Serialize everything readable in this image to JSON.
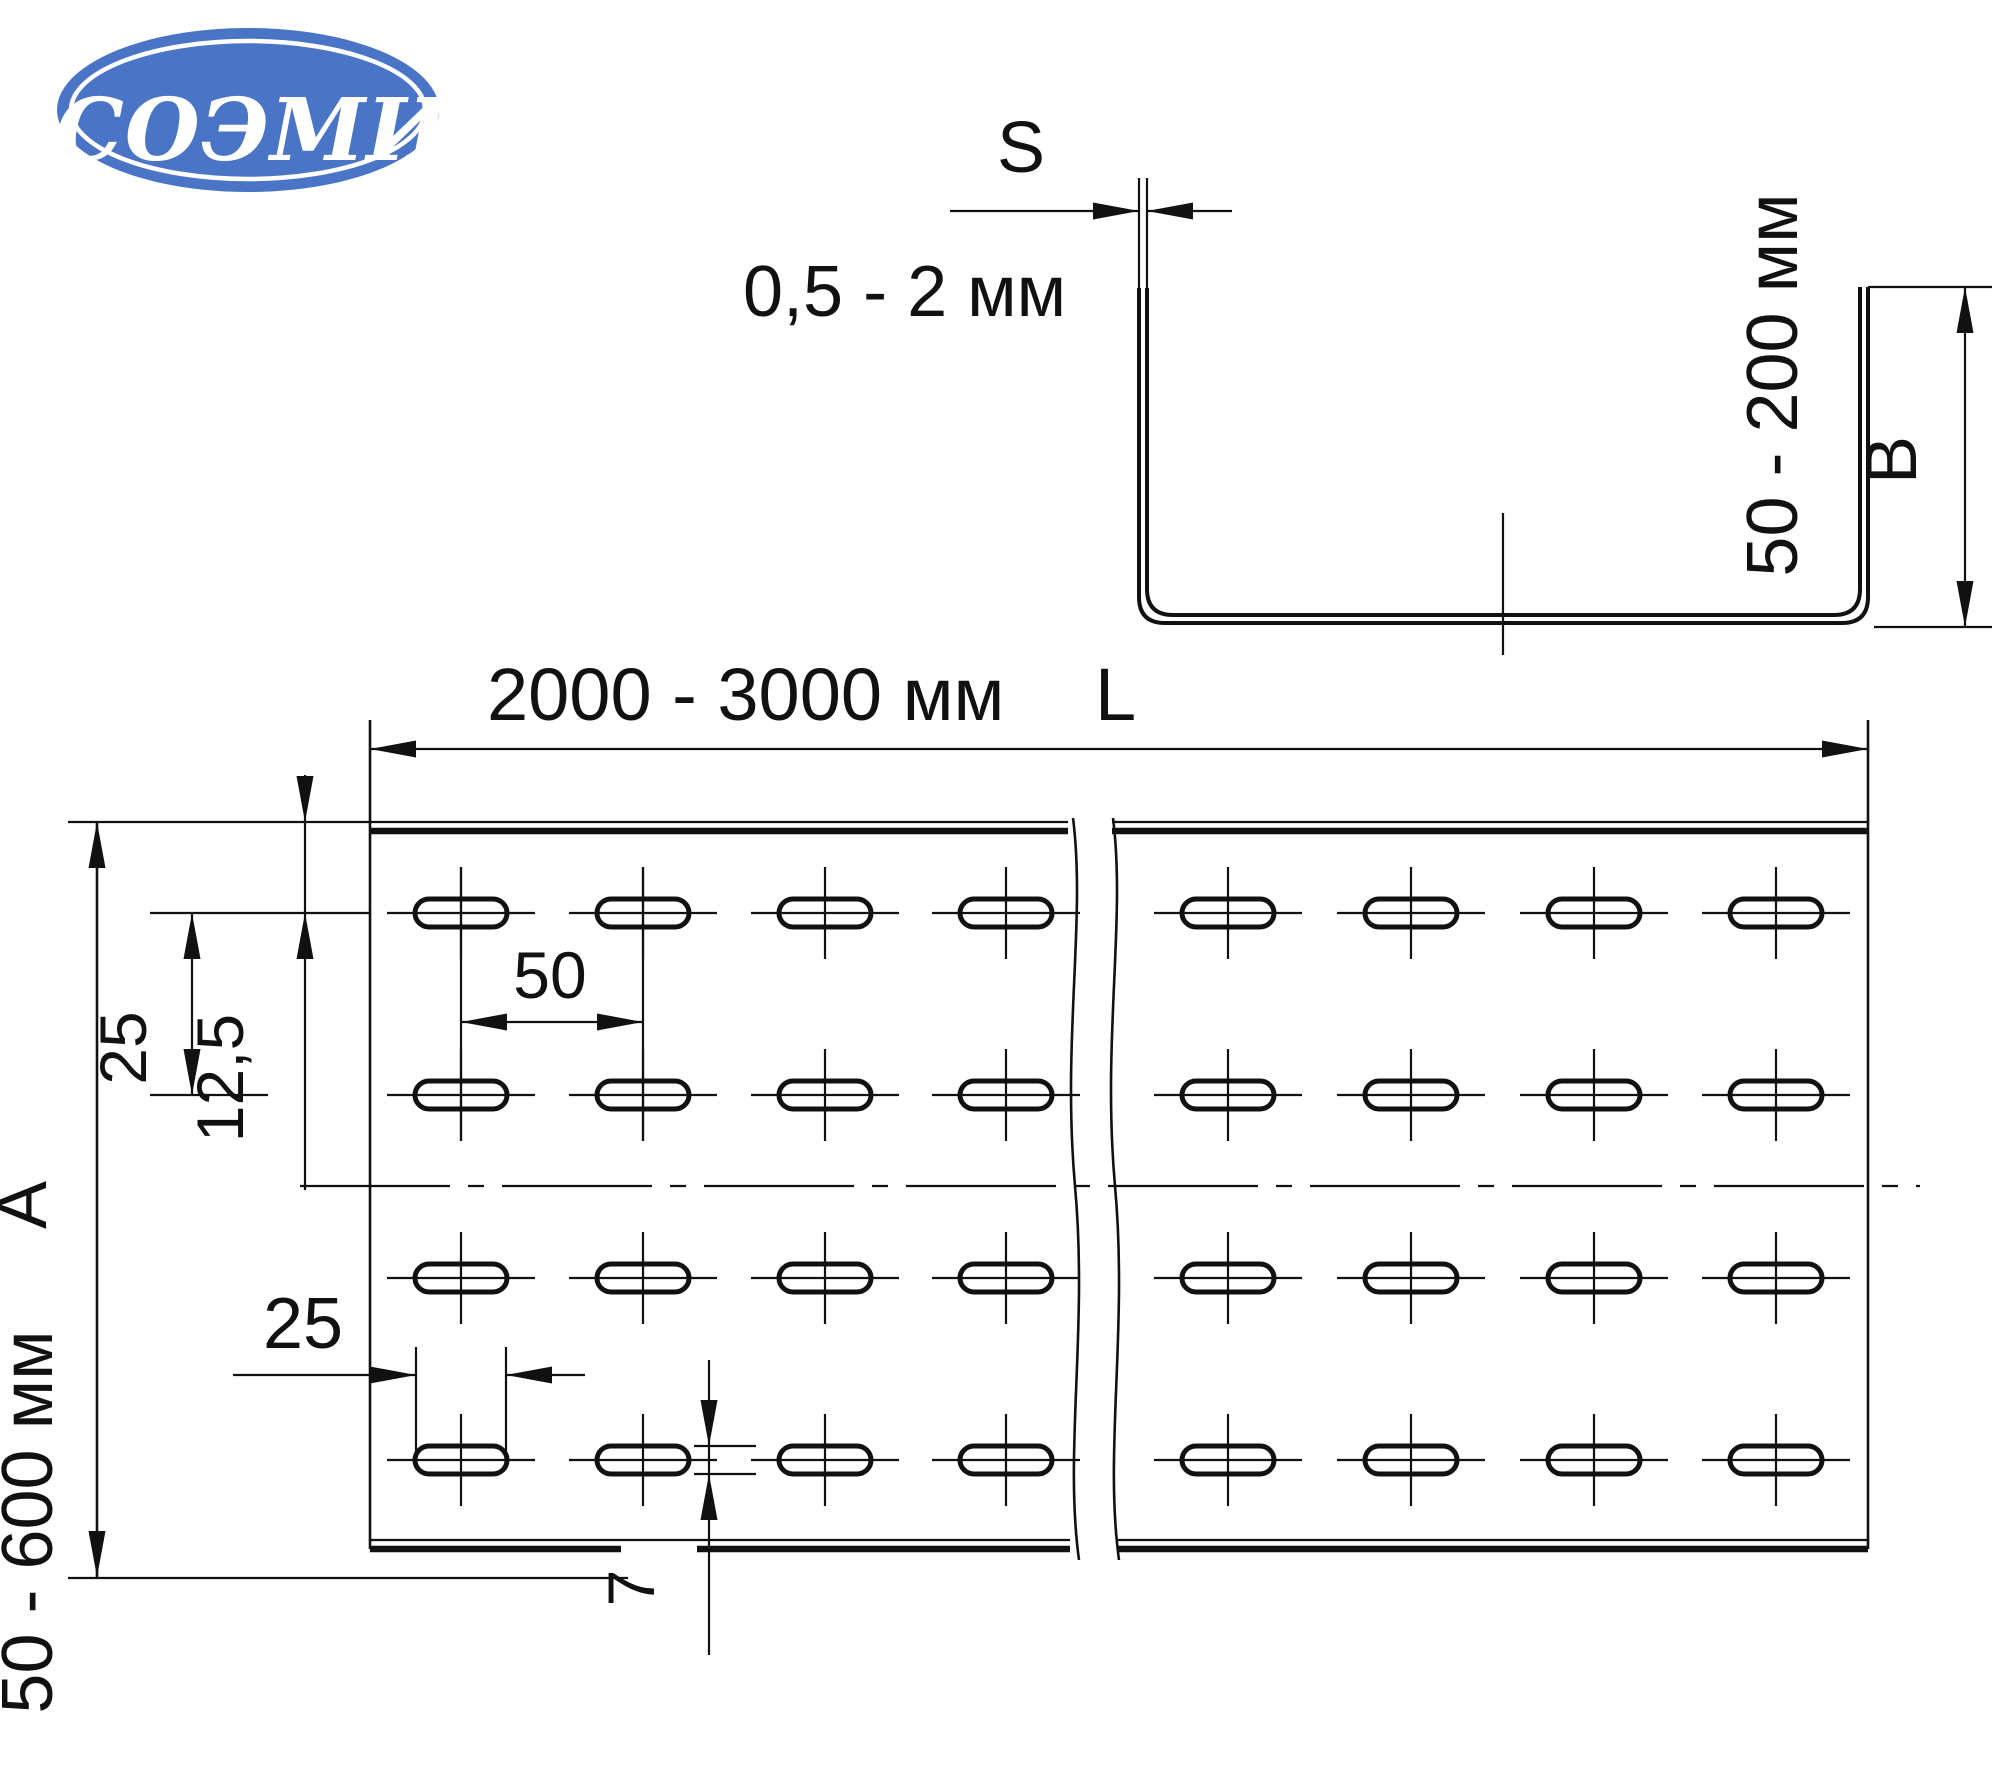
{
  "colors": {
    "background": "#ffffff",
    "line": "#111111",
    "logo_blue": "#4a74c6",
    "logo_text": "#ffffff"
  },
  "logo": {
    "text": "СОЭМИ"
  },
  "cross_section": {
    "thickness_letter": "S",
    "thickness_range": "0,5 - 2 мм",
    "side_height_range": "50 - 200 мм",
    "side_height_letter": "B"
  },
  "plan_view": {
    "length_range": "2000 - 3000 мм",
    "length_letter": "L",
    "width_range": "50 - 600 мм",
    "width_letter": "A",
    "row_pitch": "25",
    "first_row_offset": "12,5",
    "hole_column_pitch": "50",
    "hole_length": "25",
    "hole_height": "7"
  },
  "perforation": {
    "hole_rows": 4,
    "hole_columns": 8,
    "hole_type": "oblong slot"
  }
}
